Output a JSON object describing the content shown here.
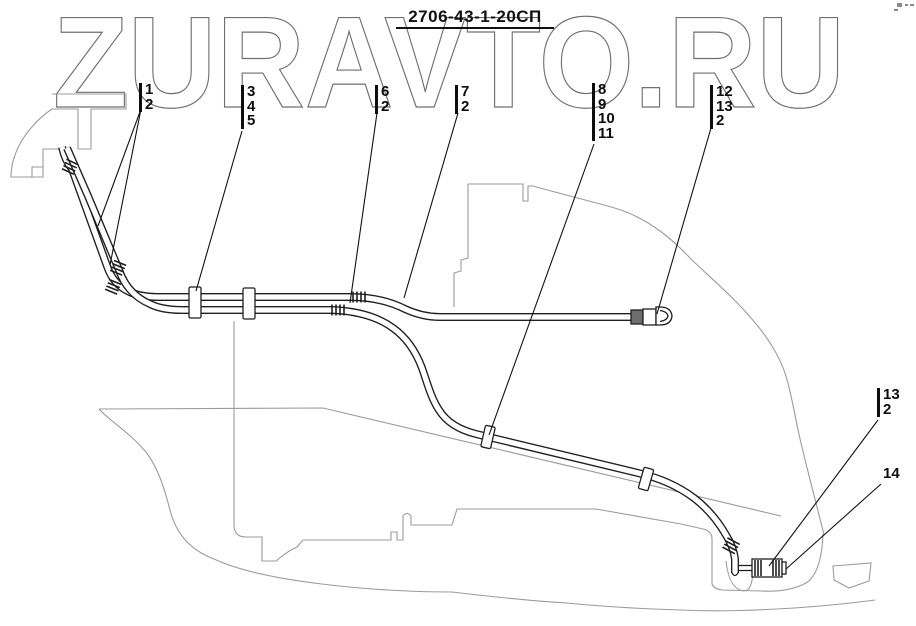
{
  "title": {
    "text": "2706-43-1-20СП"
  },
  "watermark": {
    "text": "ZURAVTO.RU"
  },
  "callouts": [
    {
      "numbers": [
        "1",
        "2"
      ]
    },
    {
      "numbers": [
        "3",
        "4",
        "5"
      ]
    },
    {
      "numbers": [
        "6",
        "2"
      ]
    },
    {
      "numbers": [
        "7",
        "2"
      ]
    },
    {
      "numbers": [
        "8",
        "9",
        "10",
        "11"
      ]
    },
    {
      "numbers": [
        "12",
        "13",
        "2"
      ]
    },
    {
      "numbers": [
        "13",
        "2"
      ]
    },
    {
      "numbers": [
        "14"
      ]
    }
  ],
  "colors": {
    "background": "#ffffff",
    "drawing_line": "#1f1f1f",
    "machine_outline": "#9b9b9b",
    "watermark_outline": "#6f6f6f",
    "fitting_fill": "#6e6e6e"
  }
}
